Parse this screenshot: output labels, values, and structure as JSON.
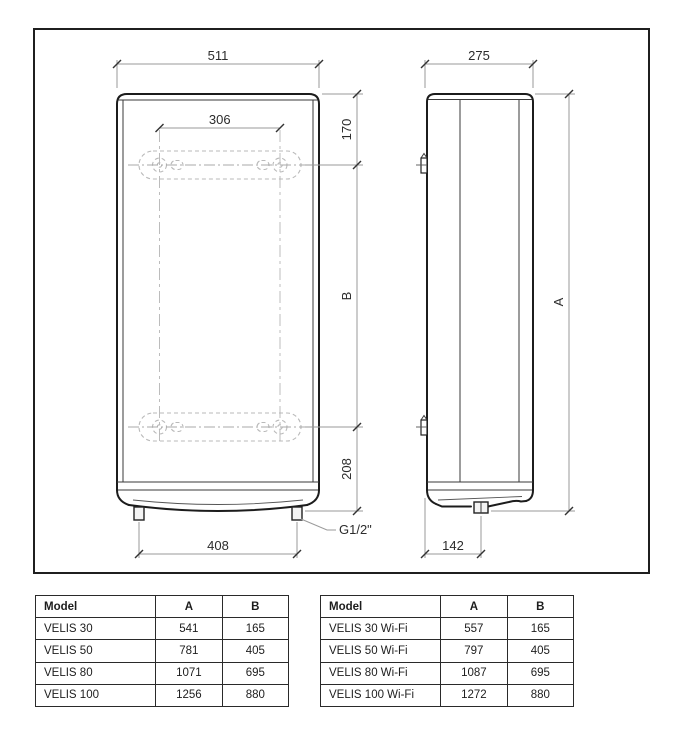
{
  "drawing": {
    "front": {
      "dim_width": "511",
      "dim_bracket_width": "306",
      "dim_top_to_bracket": "170",
      "dim_bracket_span": "B",
      "dim_bracket_to_bottom": "208",
      "dim_connections": "408",
      "thread_label": "G1/2\""
    },
    "side": {
      "dim_depth": "275",
      "dim_height": "A",
      "dim_connection_offset": "142"
    }
  },
  "tables": {
    "left": {
      "headers": {
        "model": "Model",
        "a": "A",
        "b": "B"
      },
      "rows": [
        {
          "model": "VELIS 30",
          "a": "541",
          "b": "165"
        },
        {
          "model": "VELIS 50",
          "a": "781",
          "b": "405"
        },
        {
          "model": "VELIS 80",
          "a": "1071",
          "b": "695"
        },
        {
          "model": "VELIS 100",
          "a": "1256",
          "b": "880"
        }
      ]
    },
    "right": {
      "headers": {
        "model": "Model",
        "a": "A",
        "b": "B"
      },
      "rows": [
        {
          "model": "VELIS 30 Wi-Fi",
          "a": "557",
          "b": "165"
        },
        {
          "model": "VELIS 50 Wi-Fi",
          "a": "797",
          "b": "405"
        },
        {
          "model": "VELIS 80 Wi-Fi",
          "a": "1087",
          "b": "695"
        },
        {
          "model": "VELIS 100 Wi-Fi",
          "a": "1272",
          "b": "880"
        }
      ]
    }
  },
  "colors": {
    "outline": "#1c1c1c",
    "dimension_lines": "#9a9a9a",
    "hidden_detail": "#b9b9b9",
    "background": "#ffffff"
  }
}
